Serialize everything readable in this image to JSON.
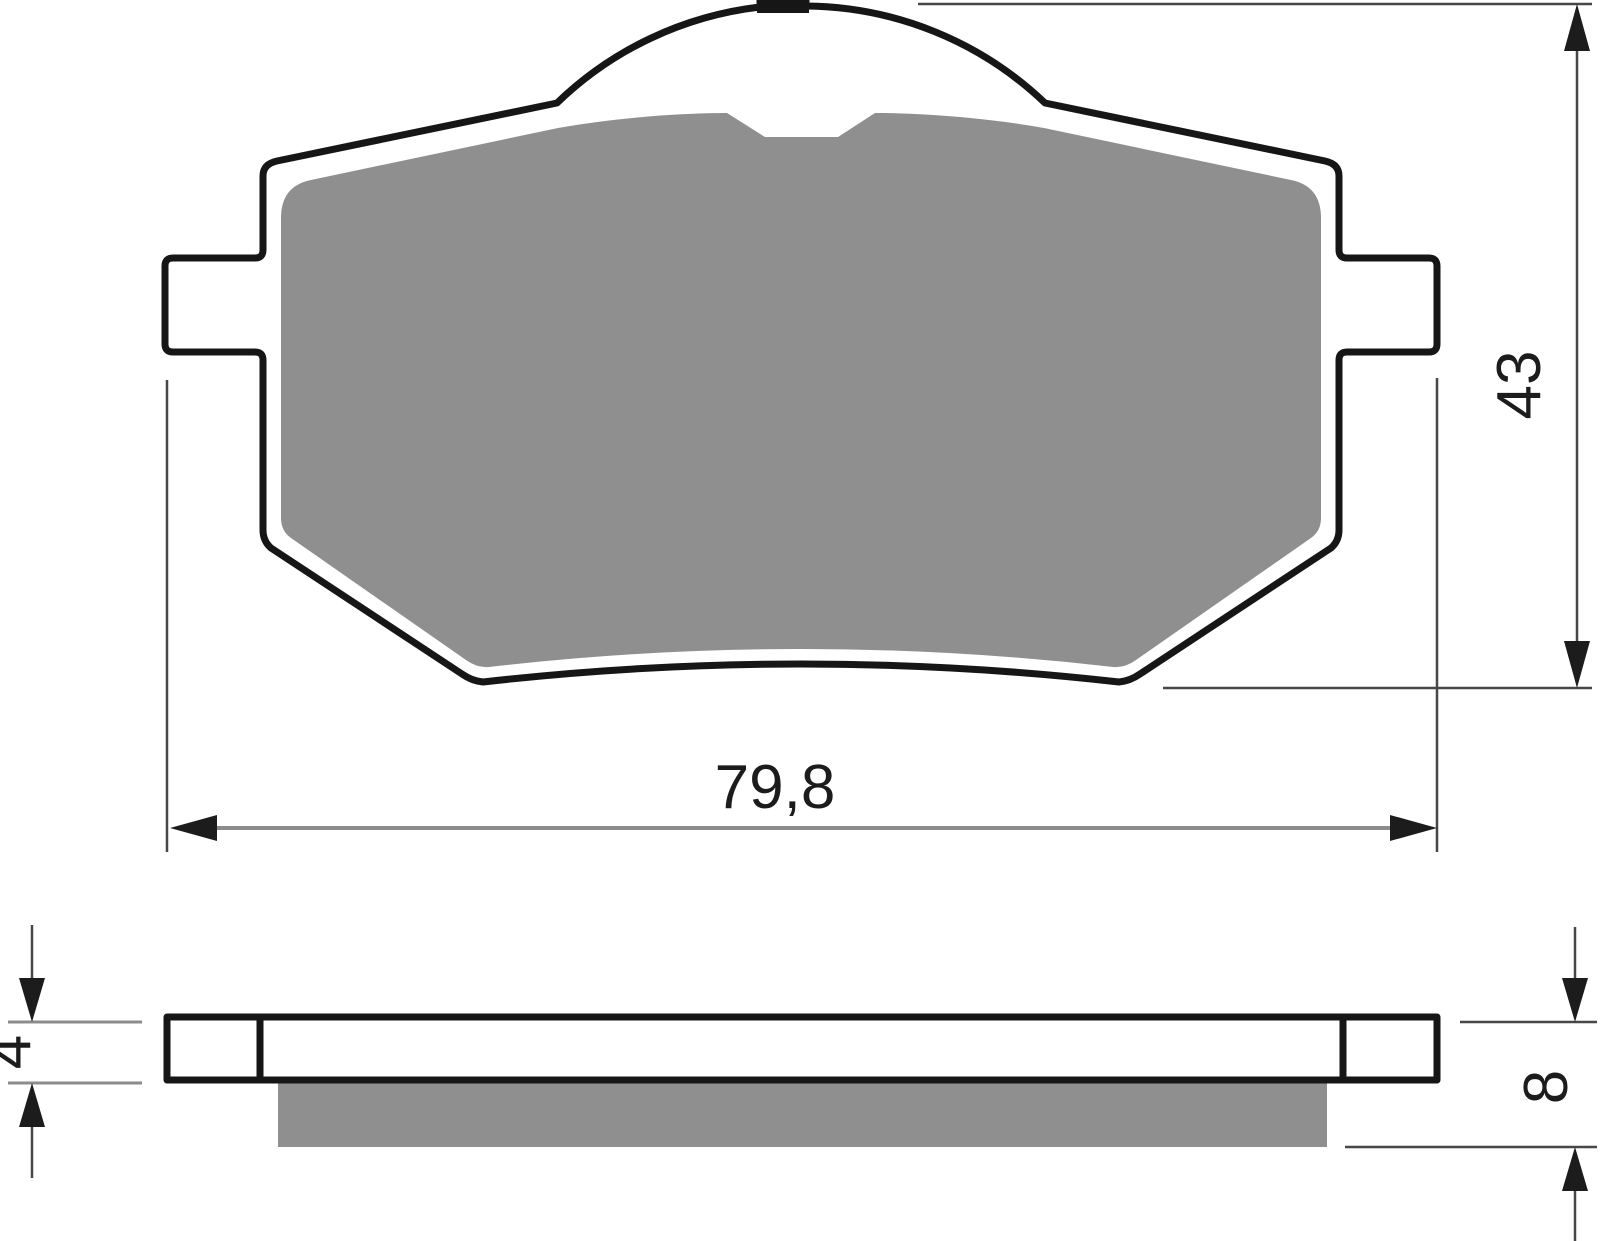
{
  "page": {
    "kind": "technical dimension drawing",
    "subject": "brake pad (front view and side profile view)",
    "background": "#ffffff"
  },
  "views": {
    "front": {
      "name": "front-view",
      "features": [
        "backing-plate",
        "friction-material",
        "left-tab",
        "right-tab",
        "top-dome",
        "top-nub",
        "friction-notch"
      ]
    },
    "side": {
      "name": "side-profile-view",
      "features": [
        "backing-plate-bar",
        "tab-end-caps",
        "friction-material-layer"
      ]
    }
  },
  "dimensions": {
    "width": {
      "label": "79,8",
      "orientation": "horizontal"
    },
    "height": {
      "label": "43",
      "orientation": "vertical"
    },
    "plate_thickness": {
      "label": "4",
      "orientation": "vertical"
    },
    "total_thickness": {
      "label": "8",
      "orientation": "vertical"
    }
  },
  "colors": {
    "outline": "#161616",
    "friction_material": "#8f8f8f",
    "dimension_line_gray": "#8c8c8c",
    "thin_line": "#474747",
    "arrow": "#1c1c1c",
    "text": "#1c1c1c",
    "background": "#ffffff"
  }
}
